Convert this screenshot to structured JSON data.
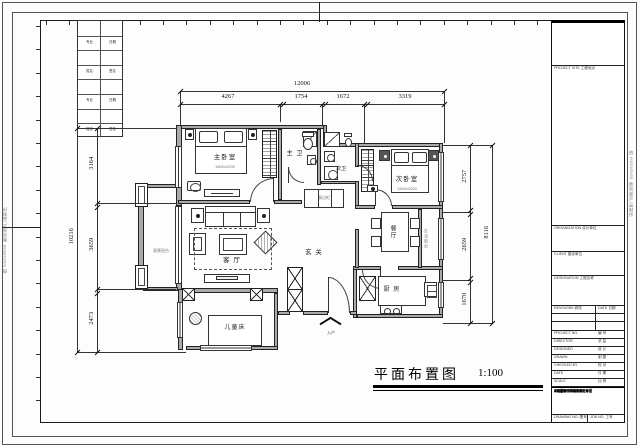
{
  "sheet": {
    "watermark_left": "由 Autodesk 教育版产品制作",
    "watermark_right": "由 Autodesk 教育版产品制作",
    "drawing_title": "平面布置图",
    "drawing_scale": "1:100"
  },
  "dims": {
    "top_overall": "12006",
    "top_segments": [
      "4267",
      "1754",
      "1672",
      "3319"
    ],
    "left_overall": "10216",
    "left_segments": [
      "3164",
      "3659",
      "2473"
    ],
    "right_overall": "8116",
    "right_segments": [
      "2757",
      "2659",
      "1670"
    ]
  },
  "rooms": {
    "master_bedroom": "主卧室",
    "master_bedroom_bed_size": "1800x2000",
    "second_bedroom": "次卧室",
    "second_bedroom_bed_size": "1500x2000",
    "living_room": "客 厅",
    "hall": "玄 关",
    "dining": "餐厅",
    "kitchen": "厨 房",
    "master_bath": "主 卫",
    "second_bath": "次卫",
    "children_bed": "儿童床",
    "view_balcony": "观景阳台",
    "service_balcony": "生活阳台",
    "sideboard": "餐边柜",
    "entry": "入户"
  },
  "sign_strip": {
    "cells": [
      [
        "专业",
        "日期"
      ],
      [
        "姓名",
        "签名"
      ],
      [
        "专业",
        "日期"
      ],
      [
        "姓名",
        "签名"
      ]
    ]
  },
  "title_block": {
    "project_site": "PROJECT SITE 工程地点",
    "organization": "ORGANIZATION 设计单位",
    "client": "CLIENT 建设单位",
    "designation": "DESIGNATION 工程名称",
    "revisions": "REVISIONS 修改",
    "rev_date": "DATE 日期",
    "rows": [
      {
        "en": "PROJECT NO.",
        "cn": "编 号"
      },
      {
        "en": "DIRECTOR",
        "cn": "总 监"
      },
      {
        "en": "DESIGNED",
        "cn": "设 计"
      },
      {
        "en": "DRAWN",
        "cn": "制 图"
      },
      {
        "en": "CHECKED BY",
        "cn": "校 对"
      },
      {
        "en": "DATE",
        "cn": "日 期"
      },
      {
        "en": "SCALE",
        "cn": "比 例"
      }
    ],
    "notes": [
      "说明:",
      "1.图中尺寸均以毫米为单位",
      "2.施工尺寸以现场实测为准",
      "3.本图版权归设计方所有",
      "未经许可不得复制转让本图",
      "All rights reserved."
    ],
    "drawing_no": "DRAWING NO. 图号",
    "job_no": "JOB NO. 工号"
  }
}
